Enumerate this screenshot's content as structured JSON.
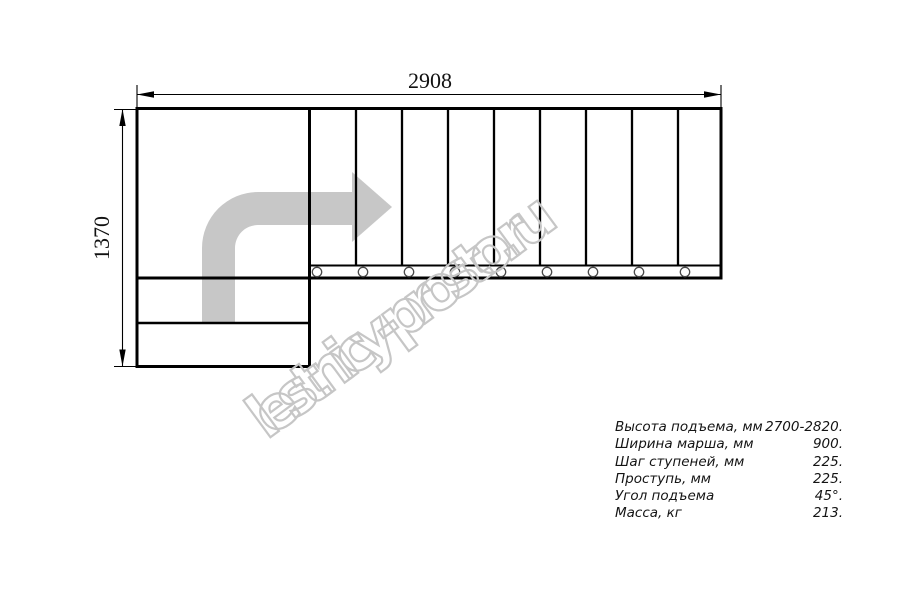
{
  "watermark": {
    "text": "lestnicy-prosto.ru"
  },
  "dimensions": {
    "width_label": "2908",
    "height_label": "1370"
  },
  "plan": {
    "tread_count": 9,
    "joint_circle_count": 9,
    "lower_step_count": 2
  },
  "specs": {
    "rows": [
      {
        "label": "Высота подъема, мм",
        "value": "2700-2820."
      },
      {
        "label": "Ширина марша, мм",
        "value": "900."
      },
      {
        "label": "Шаг ступеней, мм",
        "value": "225."
      },
      {
        "label": "Проступь, мм",
        "value": "225."
      },
      {
        "label": "Угол подъема",
        "value": "45°."
      },
      {
        "label": "Масса, кг",
        "value": "213."
      }
    ]
  },
  "colors": {
    "line": "#000000",
    "arrow_fill": "#c7c7c7",
    "watermark_stroke": "#c6c6c6"
  }
}
